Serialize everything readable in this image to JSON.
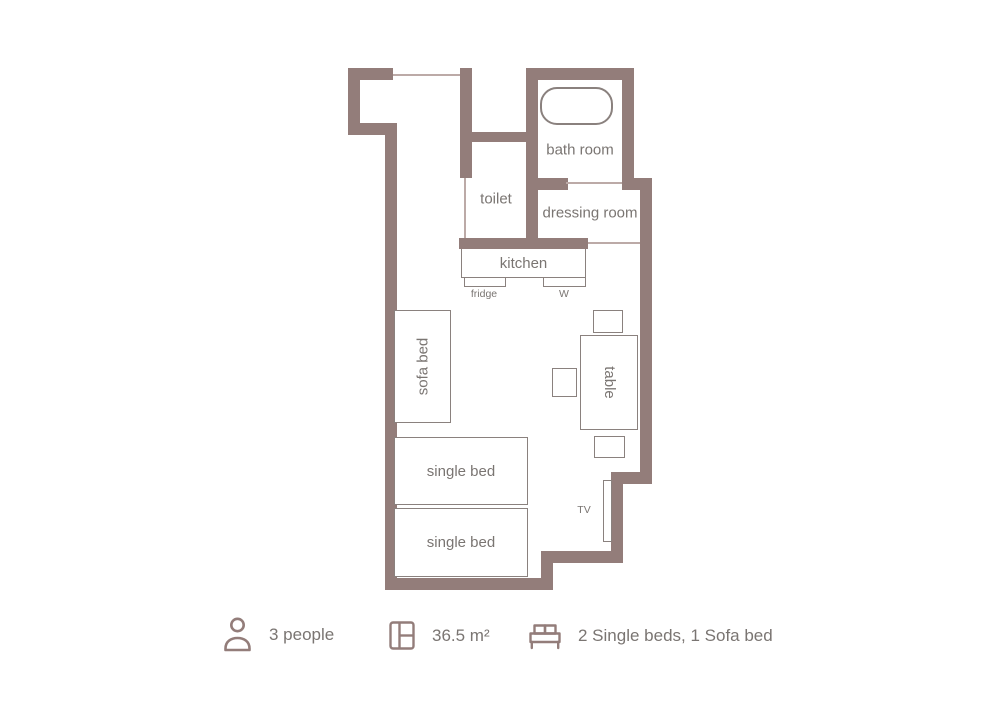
{
  "colors": {
    "wall": "#937d7a",
    "thin_line": "#bcaaa7",
    "furniture_outline": "#8a817e",
    "label_text": "#7a7572",
    "background": "#ffffff"
  },
  "rooms": {
    "bathroom": "bath room",
    "toilet": "toilet",
    "dressing_room": "dressing room",
    "kitchen": "kitchen"
  },
  "furniture": {
    "fridge": "fridge",
    "washer": "W",
    "sofa_bed": "sofa bed",
    "table": "table",
    "single_bed_top": "single bed",
    "single_bed_bottom": "single bed",
    "tv": "TV"
  },
  "legend": {
    "occupancy": {
      "icon": "person-icon",
      "label": "3 people"
    },
    "area": {
      "icon": "floor-plan-icon",
      "label": "36.5 m²"
    },
    "beds": {
      "icon": "bed-icon",
      "label": "2 Single beds, 1 Sofa bed"
    }
  }
}
